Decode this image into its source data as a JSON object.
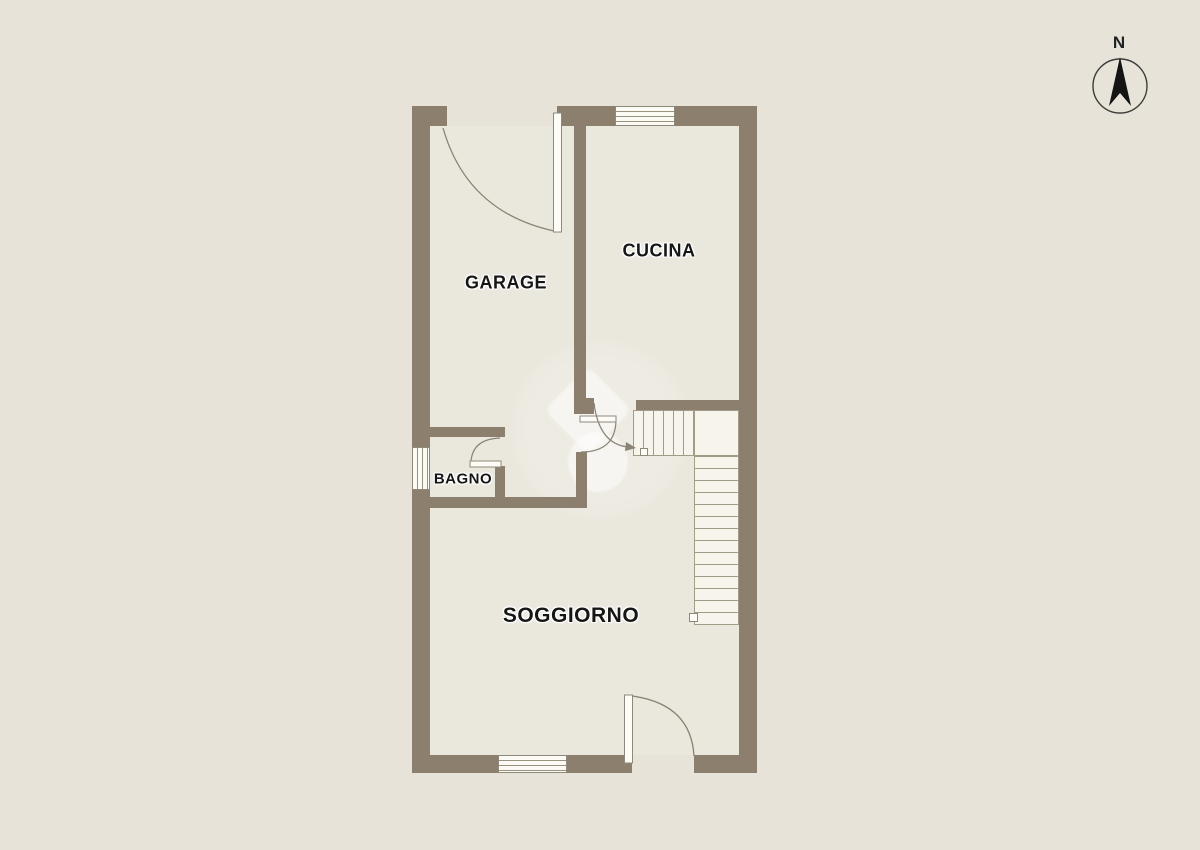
{
  "title": "Planimetria piano terra",
  "colors": {
    "background": "#e7e3d8",
    "floor": "#eae7dd",
    "wall": "#8c7f6d",
    "stair_fill": "#f7f4ec",
    "line": "#8a8375",
    "label_text": "#161616"
  },
  "compass": {
    "label": "N"
  },
  "rooms": [
    {
      "id": "garage",
      "label": "GARAGE"
    },
    {
      "id": "cucina",
      "label": "CUCINA"
    },
    {
      "id": "bagno",
      "label": "BAGNO"
    },
    {
      "id": "soggiorno",
      "label": "SOGGIORNO"
    }
  ],
  "features": {
    "stairs": "L-shaped staircase, upper right of living area",
    "windows": 3,
    "doors": 5,
    "watermark": "white diamond-and-circle agency logo"
  }
}
